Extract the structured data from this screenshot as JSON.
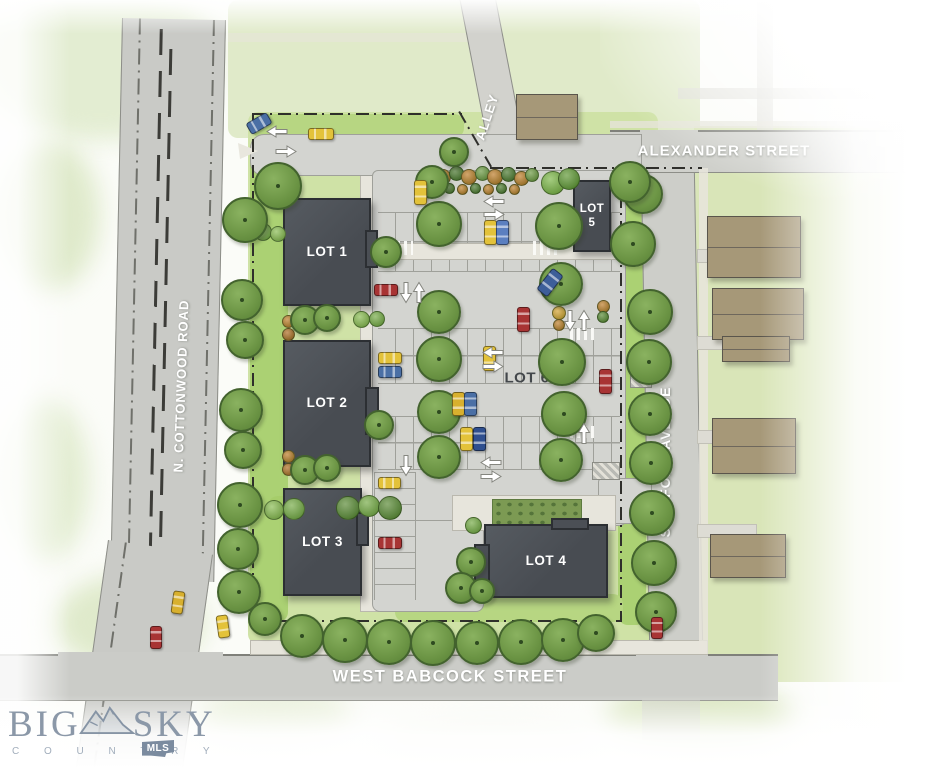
{
  "map": {
    "lots": [
      {
        "label": "LOT 1"
      },
      {
        "label": "LOT 2"
      },
      {
        "label": "LOT 3"
      },
      {
        "label": "LOT 4"
      },
      {
        "label": "LOT 5"
      },
      {
        "label": "LOT 6"
      }
    ],
    "streets": [
      {
        "label": "ALLEY"
      },
      {
        "label": "ALEXANDER STREET"
      },
      {
        "label": "N. COTTONWOOD ROAD"
      },
      {
        "label": "STAFFORD AVENUE"
      },
      {
        "label": "WEST BABCOCK STREET"
      }
    ],
    "logo": {
      "word1": "BIG",
      "word2": "SKY",
      "subtitle": "C O U N T R Y",
      "badge": "MLS"
    }
  },
  "colors": {
    "building": "#4b4f55",
    "house": "#a69878",
    "road": "#cbccc7",
    "parking": "#d3d4d0",
    "lawn": "#cfe2a6",
    "tree": "#6b9444",
    "logo": "#8b98a8"
  },
  "scene": {
    "drives": [
      [
        697,
        249,
        58,
        12
      ],
      [
        697,
        336,
        58,
        12
      ],
      [
        697,
        430,
        58,
        12
      ],
      [
        697,
        524,
        58,
        12
      ]
    ],
    "houses": [
      [
        516,
        94,
        60,
        44
      ],
      [
        707,
        216,
        92,
        60
      ],
      [
        712,
        288,
        90,
        50
      ],
      [
        722,
        336,
        66,
        24
      ],
      [
        712,
        418,
        82,
        54
      ],
      [
        710,
        534,
        74,
        42
      ]
    ],
    "hatches": [
      [
        630,
        362,
        20,
        24
      ],
      [
        592,
        462,
        26,
        16
      ]
    ],
    "crosswalks": [
      [
        533,
        241,
        26,
        14
      ],
      [
        397,
        241,
        16,
        14
      ],
      [
        570,
        328,
        24,
        12
      ],
      [
        570,
        426,
        24,
        12
      ],
      [
        644,
        608,
        28,
        12
      ]
    ],
    "shrubs": [
      [
        442,
        176,
        14,
        "#bf7f2d"
      ],
      [
        455,
        172,
        13,
        "#4e7a33"
      ],
      [
        468,
        176,
        14,
        "#bf7f2d"
      ],
      [
        481,
        172,
        13,
        "#6f9b46"
      ],
      [
        494,
        176,
        14,
        "#bf7f2d"
      ],
      [
        507,
        173,
        13,
        "#4e7a33"
      ],
      [
        520,
        177,
        13,
        "#bf7f2d"
      ],
      [
        531,
        174,
        12,
        "#6f9b46"
      ],
      [
        448,
        187,
        9,
        "#4e7a33"
      ],
      [
        461,
        188,
        9,
        "#bf7f2d"
      ],
      [
        474,
        187,
        9,
        "#4e7a33"
      ],
      [
        487,
        188,
        9,
        "#bf7f2d"
      ],
      [
        500,
        187,
        9,
        "#4e7a33"
      ],
      [
        513,
        188,
        9,
        "#bf7f2d"
      ],
      [
        552,
        182,
        22,
        "#7fb84b"
      ],
      [
        568,
        178,
        20,
        "#639a39"
      ],
      [
        287,
        320,
        11,
        "#bf7f2d"
      ],
      [
        287,
        333,
        11,
        "#b06f28"
      ],
      [
        287,
        455,
        11,
        "#bf7f2d"
      ],
      [
        287,
        468,
        11,
        "#b06f28"
      ],
      [
        360,
        318,
        15,
        "#8cbd55"
      ],
      [
        376,
        318,
        14,
        "#79ad4a"
      ],
      [
        273,
        509,
        18,
        "#8cbd55"
      ],
      [
        293,
        508,
        20,
        "#79ad4a"
      ],
      [
        347,
        507,
        22,
        "#5d8c39"
      ],
      [
        368,
        505,
        20,
        "#79ad4a"
      ],
      [
        389,
        507,
        22,
        "#5d8c39"
      ],
      [
        602,
        305,
        11,
        "#bf7f2d"
      ],
      [
        602,
        316,
        10,
        "#5d8c39"
      ],
      [
        558,
        312,
        12,
        "#d8a636"
      ],
      [
        558,
        324,
        10,
        "#bf7f2d"
      ],
      [
        472,
        524,
        15,
        "#79ad4a"
      ],
      [
        262,
        231,
        16,
        "#79ad4a"
      ],
      [
        277,
        233,
        14,
        "#8cbd55"
      ]
    ],
    "trees": [
      [
        276,
        184,
        44
      ],
      [
        243,
        218,
        42
      ],
      [
        240,
        298,
        38
      ],
      [
        243,
        338,
        34
      ],
      [
        239,
        408,
        40
      ],
      [
        241,
        448,
        34
      ],
      [
        238,
        503,
        42
      ],
      [
        236,
        547,
        38
      ],
      [
        237,
        590,
        40
      ],
      [
        263,
        617,
        30
      ],
      [
        300,
        634,
        40
      ],
      [
        343,
        638,
        42
      ],
      [
        387,
        640,
        42
      ],
      [
        431,
        641,
        42
      ],
      [
        475,
        641,
        40
      ],
      [
        519,
        640,
        42
      ],
      [
        561,
        638,
        40
      ],
      [
        594,
        631,
        34
      ],
      [
        641,
        192,
        36
      ],
      [
        631,
        242,
        42
      ],
      [
        648,
        310,
        42
      ],
      [
        647,
        360,
        42
      ],
      [
        648,
        412,
        40
      ],
      [
        649,
        461,
        40
      ],
      [
        650,
        511,
        42
      ],
      [
        652,
        561,
        42
      ],
      [
        654,
        610,
        38
      ],
      [
        437,
        222,
        42
      ],
      [
        437,
        310,
        40
      ],
      [
        437,
        357,
        42
      ],
      [
        437,
        410,
        40
      ],
      [
        437,
        455,
        40
      ],
      [
        557,
        224,
        44
      ],
      [
        559,
        282,
        40
      ],
      [
        560,
        360,
        44
      ],
      [
        562,
        412,
        42
      ],
      [
        559,
        458,
        40
      ],
      [
        377,
        423,
        26
      ],
      [
        384,
        250,
        28
      ],
      [
        303,
        318,
        26
      ],
      [
        325,
        316,
        24
      ],
      [
        303,
        468,
        26
      ],
      [
        325,
        466,
        24
      ],
      [
        430,
        180,
        30
      ],
      [
        452,
        150,
        26
      ],
      [
        628,
        180,
        38
      ],
      [
        469,
        560,
        26
      ],
      [
        459,
        586,
        28
      ],
      [
        480,
        589,
        22
      ]
    ],
    "cars": [
      [
        258,
        122,
        22,
        11,
        "#4a6fa5",
        -30
      ],
      [
        320,
        133,
        24,
        10,
        "#e3c23a",
        0
      ],
      [
        419,
        191,
        11,
        23,
        "#e3c23a",
        0
      ],
      [
        489,
        231,
        11,
        23,
        "#e3c23a",
        0
      ],
      [
        501,
        231,
        11,
        23,
        "#5b7fc0",
        0
      ],
      [
        549,
        281,
        12,
        25,
        "#3d5e99",
        38
      ],
      [
        522,
        318,
        11,
        23,
        "#a83434",
        0
      ],
      [
        488,
        357,
        11,
        23,
        "#e3c23a",
        0
      ],
      [
        604,
        380,
        11,
        23,
        "#a83434",
        0
      ],
      [
        457,
        403,
        11,
        22,
        "#d8b02e",
        0
      ],
      [
        469,
        403,
        11,
        22,
        "#4a6fa5",
        0
      ],
      [
        465,
        438,
        11,
        22,
        "#e3c23a",
        0
      ],
      [
        478,
        438,
        11,
        22,
        "#2f4f8f",
        0
      ],
      [
        385,
        289,
        22,
        10,
        "#a83434",
        0
      ],
      [
        389,
        357,
        22,
        10,
        "#e3c23a",
        0
      ],
      [
        389,
        371,
        22,
        10,
        "#4a6fa5",
        0
      ],
      [
        388,
        482,
        21,
        10,
        "#e3c23a",
        0
      ],
      [
        389,
        542,
        22,
        10,
        "#a83434",
        0
      ],
      [
        177,
        601,
        10,
        21,
        "#d8b02e",
        8
      ],
      [
        155,
        636,
        10,
        21,
        "#a83434",
        0
      ],
      [
        222,
        625,
        10,
        21,
        "#e3c23a",
        -8
      ],
      [
        656,
        627,
        10,
        20,
        "#a83434",
        0
      ]
    ],
    "arrows": [
      [
        277,
        131,
        "left"
      ],
      [
        286,
        151,
        "right"
      ],
      [
        494,
        201,
        "left"
      ],
      [
        494,
        214,
        "right"
      ],
      [
        493,
        352,
        "left"
      ],
      [
        493,
        366,
        "right"
      ],
      [
        491,
        462,
        "left"
      ],
      [
        491,
        476,
        "right"
      ],
      [
        406,
        292,
        "down"
      ],
      [
        419,
        292,
        "up"
      ],
      [
        406,
        465,
        "down"
      ],
      [
        570,
        320,
        "down"
      ],
      [
        584,
        320,
        "up"
      ],
      [
        584,
        433,
        "up"
      ]
    ]
  }
}
